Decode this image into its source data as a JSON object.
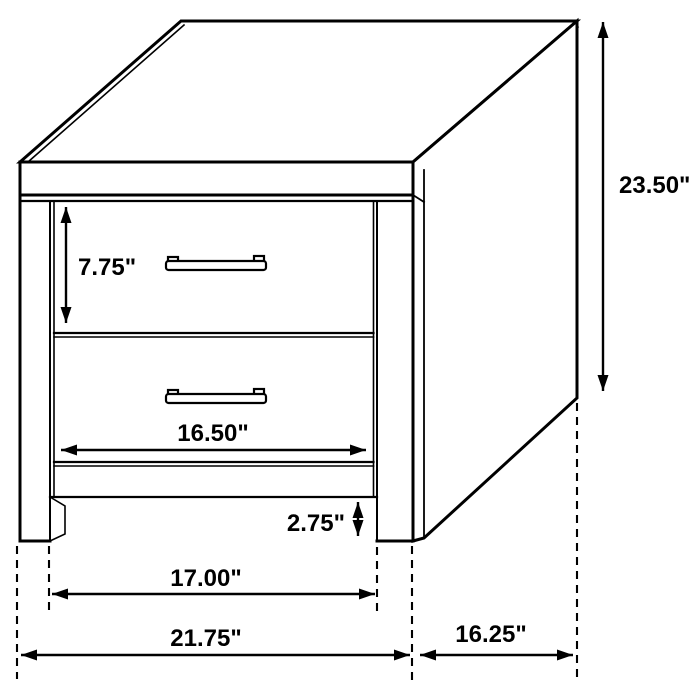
{
  "diagram": {
    "subject": "2-drawer nightstand dimension drawing",
    "unit": "inches",
    "colors": {
      "line": "#000000",
      "background": "#ffffff"
    },
    "dimensions": {
      "overall_height": {
        "label": "23.50\"",
        "value": 23.5
      },
      "drawer_height": {
        "label": "7.75\"",
        "value": 7.75
      },
      "drawer_width": {
        "label": "16.50\"",
        "value": 16.5
      },
      "base_height": {
        "label": "2.75\"",
        "value": 2.75
      },
      "leg_span": {
        "label": "17.00\"",
        "value": 17.0
      },
      "overall_width": {
        "label": "21.75\"",
        "value": 21.75
      },
      "depth": {
        "label": "16.25\"",
        "value": 16.25
      }
    }
  }
}
